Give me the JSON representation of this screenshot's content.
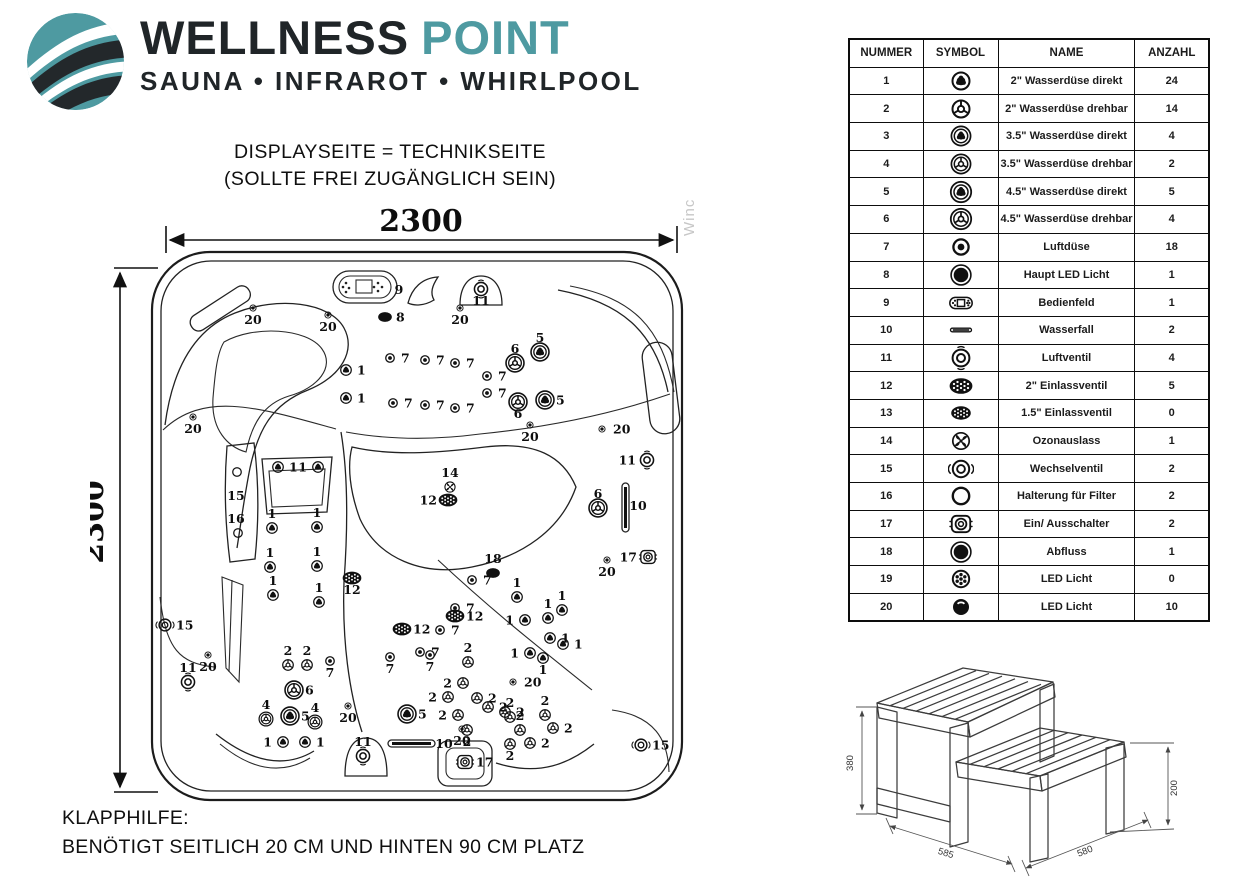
{
  "colors": {
    "teal": "#4E9AA1",
    "ink": "#202528"
  },
  "logo": {
    "icon": "globe-swoosh-icon",
    "brand_primary": "WELLNESS",
    "brand_secondary": "POINT",
    "tagline": "SAUNA • INFRAROT • WHIRLPOOL"
  },
  "note_top": {
    "line1": "DISPLAYSEITE = TECHNIKSEITE",
    "line2": "(SOLLTE FREI ZUGÄNGLICH SEIN)"
  },
  "note_bottom": {
    "line1": "KLAPPHILFE:",
    "line2": "BENÖTIGT SEITLICH 20 CM UND HINTEN 90 CM PLATZ"
  },
  "watermark": "Winc",
  "diagram": {
    "width_label": "2300",
    "height_label": "2300",
    "jets": [
      {
        "x": 253,
        "y": 308,
        "t": "dot",
        "l": "20",
        "p": "b"
      },
      {
        "x": 328,
        "y": 315,
        "t": "dot",
        "l": "20",
        "p": "b"
      },
      {
        "x": 460,
        "y": 308,
        "t": "dot",
        "l": "20",
        "p": "b"
      },
      {
        "x": 193,
        "y": 417,
        "t": "dot",
        "l": "20",
        "p": "b"
      },
      {
        "x": 385,
        "y": 317,
        "t": "dark8",
        "l": "8",
        "p": "r"
      },
      {
        "x": 399,
        "y": 290,
        "t": "none",
        "l": "9",
        "p": "c"
      },
      {
        "x": 481,
        "y": 289,
        "t": "ring11",
        "l": "11",
        "p": "b"
      },
      {
        "x": 346,
        "y": 370,
        "t": "s1",
        "l": "1",
        "p": "r"
      },
      {
        "x": 346,
        "y": 398,
        "t": "s1",
        "l": "1",
        "p": "r"
      },
      {
        "x": 390,
        "y": 358,
        "t": "a",
        "l": "7",
        "p": "r"
      },
      {
        "x": 425,
        "y": 360,
        "t": "a",
        "l": "7",
        "p": "r"
      },
      {
        "x": 455,
        "y": 363,
        "t": "a",
        "l": "7",
        "p": "r"
      },
      {
        "x": 487,
        "y": 376,
        "t": "a",
        "l": "7",
        "p": "r"
      },
      {
        "x": 393,
        "y": 403,
        "t": "a",
        "l": "7",
        "p": "r"
      },
      {
        "x": 425,
        "y": 405,
        "t": "a",
        "l": "7",
        "p": "r"
      },
      {
        "x": 455,
        "y": 408,
        "t": "a",
        "l": "7",
        "p": "r"
      },
      {
        "x": 487,
        "y": 393,
        "t": "a",
        "l": "7",
        "p": "r"
      },
      {
        "x": 515,
        "y": 363,
        "t": "b6",
        "l": "6",
        "p": "t"
      },
      {
        "x": 540,
        "y": 352,
        "t": "b5",
        "l": "5",
        "p": "t"
      },
      {
        "x": 518,
        "y": 402,
        "t": "b6",
        "l": "6",
        "p": "b"
      },
      {
        "x": 545,
        "y": 400,
        "t": "b5",
        "l": "5",
        "p": "r"
      },
      {
        "x": 530,
        "y": 425,
        "t": "dot",
        "l": "20",
        "p": "b"
      },
      {
        "x": 602,
        "y": 429,
        "t": "dot",
        "l": "20",
        "p": "r"
      },
      {
        "x": 647,
        "y": 460,
        "t": "ring11",
        "l": "11",
        "p": "l"
      },
      {
        "x": 638,
        "y": 506,
        "t": "none",
        "l": "10",
        "p": "c"
      },
      {
        "x": 648,
        "y": 557,
        "t": "sw17",
        "l": "17",
        "p": "l"
      },
      {
        "x": 607,
        "y": 560,
        "t": "dot",
        "l": "20",
        "p": "b"
      },
      {
        "x": 598,
        "y": 508,
        "t": "b6",
        "l": "6",
        "p": "t"
      },
      {
        "x": 472,
        "y": 580,
        "t": "a",
        "l": "7",
        "p": "r"
      },
      {
        "x": 455,
        "y": 608,
        "t": "a",
        "l": "7",
        "p": "r"
      },
      {
        "x": 440,
        "y": 630,
        "t": "a",
        "l": "7",
        "p": "r"
      },
      {
        "x": 420,
        "y": 652,
        "t": "a",
        "l": "7",
        "p": "r"
      },
      {
        "x": 450,
        "y": 487,
        "t": "fan",
        "l": "14",
        "p": "t"
      },
      {
        "x": 448,
        "y": 500,
        "t": "oval",
        "l": "12",
        "p": "l"
      },
      {
        "x": 352,
        "y": 578,
        "t": "oval",
        "l": "12",
        "p": "b"
      },
      {
        "x": 402,
        "y": 629,
        "t": "oval",
        "l": "12",
        "p": "r"
      },
      {
        "x": 455,
        "y": 616,
        "t": "oval",
        "l": "12",
        "p": "r"
      },
      {
        "x": 493,
        "y": 573,
        "t": "dark8",
        "l": "18",
        "p": "t"
      },
      {
        "x": 517,
        "y": 597,
        "t": "s1",
        "l": "1",
        "p": "t"
      },
      {
        "x": 525,
        "y": 620,
        "t": "s1",
        "l": "1",
        "p": "l"
      },
      {
        "x": 548,
        "y": 618,
        "t": "s1",
        "l": "1",
        "p": "t"
      },
      {
        "x": 562,
        "y": 610,
        "t": "s1",
        "l": "1",
        "p": "t"
      },
      {
        "x": 550,
        "y": 638,
        "t": "s1",
        "l": "1",
        "p": "r"
      },
      {
        "x": 563,
        "y": 644,
        "t": "s1",
        "l": "1",
        "p": "r"
      },
      {
        "x": 530,
        "y": 653,
        "t": "s1",
        "l": "1",
        "p": "l"
      },
      {
        "x": 543,
        "y": 658,
        "t": "s1",
        "l": "1",
        "p": "b"
      },
      {
        "x": 272,
        "y": 528,
        "t": "s1",
        "l": "1",
        "p": "t"
      },
      {
        "x": 317,
        "y": 527,
        "t": "s1",
        "l": "1",
        "p": "t"
      },
      {
        "x": 270,
        "y": 567,
        "t": "s1",
        "l": "1",
        "p": "t"
      },
      {
        "x": 317,
        "y": 566,
        "t": "s1",
        "l": "1",
        "p": "t"
      },
      {
        "x": 273,
        "y": 595,
        "t": "s1",
        "l": "1",
        "p": "t"
      },
      {
        "x": 319,
        "y": 602,
        "t": "s1",
        "l": "1",
        "p": "t"
      },
      {
        "x": 278,
        "y": 467,
        "t": "s1",
        "l": "1",
        "p": "r"
      },
      {
        "x": 318,
        "y": 467,
        "t": "s1",
        "l": "1",
        "p": "l"
      },
      {
        "x": 237,
        "y": 472,
        "t": "c16",
        "l": "",
        "p": "c"
      },
      {
        "x": 238,
        "y": 533,
        "t": "c16",
        "l": "",
        "p": "c"
      },
      {
        "x": 236,
        "y": 496,
        "t": "none",
        "l": "15",
        "p": "c"
      },
      {
        "x": 236,
        "y": 519,
        "t": "none",
        "l": "16",
        "p": "c"
      },
      {
        "x": 208,
        "y": 655,
        "t": "dot",
        "l": "20",
        "p": "b"
      },
      {
        "x": 188,
        "y": 682,
        "t": "ring11",
        "l": "11",
        "p": "t"
      },
      {
        "x": 165,
        "y": 625,
        "t": "div15",
        "l": "15",
        "p": "r"
      },
      {
        "x": 288,
        "y": 665,
        "t": "s2",
        "l": "2",
        "p": "t"
      },
      {
        "x": 307,
        "y": 665,
        "t": "s2",
        "l": "2",
        "p": "t"
      },
      {
        "x": 330,
        "y": 661,
        "t": "a",
        "l": "7",
        "p": "b"
      },
      {
        "x": 294,
        "y": 690,
        "t": "b6",
        "l": "6",
        "p": "r"
      },
      {
        "x": 290,
        "y": 716,
        "t": "b5",
        "l": "5",
        "p": "r"
      },
      {
        "x": 266,
        "y": 719,
        "t": "b4",
        "l": "4",
        "p": "t"
      },
      {
        "x": 315,
        "y": 722,
        "t": "b4",
        "l": "4",
        "p": "t"
      },
      {
        "x": 283,
        "y": 742,
        "t": "s1",
        "l": "1",
        "p": "l"
      },
      {
        "x": 305,
        "y": 742,
        "t": "s1",
        "l": "1",
        "p": "r"
      },
      {
        "x": 348,
        "y": 706,
        "t": "dot",
        "l": "20",
        "p": "b"
      },
      {
        "x": 407,
        "y": 714,
        "t": "b5",
        "l": "5",
        "p": "r"
      },
      {
        "x": 390,
        "y": 657,
        "t": "a",
        "l": "7",
        "p": "b"
      },
      {
        "x": 430,
        "y": 655,
        "t": "a",
        "l": "7",
        "p": "b"
      },
      {
        "x": 444,
        "y": 744,
        "t": "none",
        "l": "10",
        "p": "c"
      },
      {
        "x": 363,
        "y": 756,
        "t": "ring11",
        "l": "11",
        "p": "t"
      },
      {
        "x": 462,
        "y": 729,
        "t": "dot",
        "l": "20",
        "p": "b"
      },
      {
        "x": 465,
        "y": 762,
        "t": "sw17",
        "l": "17",
        "p": "r"
      },
      {
        "x": 468,
        "y": 662,
        "t": "s2",
        "l": "2",
        "p": "t"
      },
      {
        "x": 463,
        "y": 683,
        "t": "s2",
        "l": "2",
        "p": "l"
      },
      {
        "x": 448,
        "y": 697,
        "t": "s2",
        "l": "2",
        "p": "l"
      },
      {
        "x": 477,
        "y": 698,
        "t": "s2",
        "l": "2",
        "p": "r"
      },
      {
        "x": 458,
        "y": 715,
        "t": "s2",
        "l": "2",
        "p": "l"
      },
      {
        "x": 488,
        "y": 707,
        "t": "s2",
        "l": "2",
        "p": "r"
      },
      {
        "x": 505,
        "y": 712,
        "t": "s2",
        "l": "2",
        "p": "r"
      },
      {
        "x": 467,
        "y": 730,
        "t": "s2",
        "l": "2",
        "p": "b"
      },
      {
        "x": 510,
        "y": 717,
        "t": "s2",
        "l": "2",
        "p": "t"
      },
      {
        "x": 520,
        "y": 730,
        "t": "s2",
        "l": "2",
        "p": "t"
      },
      {
        "x": 510,
        "y": 744,
        "t": "s2",
        "l": "2",
        "p": "b"
      },
      {
        "x": 530,
        "y": 743,
        "t": "s2",
        "l": "2",
        "p": "r"
      },
      {
        "x": 545,
        "y": 715,
        "t": "s2",
        "l": "2",
        "p": "t"
      },
      {
        "x": 553,
        "y": 728,
        "t": "s2",
        "l": "2",
        "p": "r"
      },
      {
        "x": 513,
        "y": 682,
        "t": "dot",
        "l": "20",
        "p": "r"
      },
      {
        "x": 641,
        "y": 745,
        "t": "div15",
        "l": "15",
        "p": "r"
      }
    ]
  },
  "table": {
    "headers": [
      "NUMMER",
      "SYMBOL",
      "NAME",
      "ANZAHL"
    ],
    "rows": [
      {
        "num": "1",
        "t": "s1",
        "symbol": "jet-2in-direct-icon",
        "name": "2\" Wasserdüse direkt",
        "qty": "24"
      },
      {
        "num": "2",
        "t": "s2",
        "symbol": "jet-2in-rotate-icon",
        "name": "2\" Wasserdüse drehbar",
        "qty": "14"
      },
      {
        "num": "3",
        "t": "m3",
        "symbol": "jet-3.5in-direct-icon",
        "name": "3.5\" Wasserdüse direkt",
        "qty": "4"
      },
      {
        "num": "4",
        "t": "b4",
        "symbol": "jet-3.5in-rotate-icon",
        "name": "3.5\" Wasserdüse drehbar",
        "qty": "2"
      },
      {
        "num": "5",
        "t": "b5",
        "symbol": "jet-4.5in-direct-icon",
        "name": "4.5\" Wasserdüse direkt",
        "qty": "5"
      },
      {
        "num": "6",
        "t": "b6",
        "symbol": "jet-4.5in-rotate-icon",
        "name": "4.5\" Wasserdüse drehbar",
        "qty": "4"
      },
      {
        "num": "7",
        "t": "a",
        "symbol": "air-jet-icon",
        "name": "Luftdüse",
        "qty": "18"
      },
      {
        "num": "8",
        "t": "drain",
        "symbol": "main-led-icon",
        "name": "Haupt LED Licht",
        "qty": "1"
      },
      {
        "num": "9",
        "t": "panel",
        "symbol": "control-panel-icon",
        "name": "Bedienfeld",
        "qty": "1"
      },
      {
        "num": "10",
        "t": "bar",
        "symbol": "waterfall-icon",
        "name": "Wasserfall",
        "qty": "2"
      },
      {
        "num": "11",
        "t": "ring11",
        "symbol": "air-valve-icon",
        "name": "Luftventil",
        "qty": "4"
      },
      {
        "num": "12",
        "t": "oval",
        "symbol": "inlet-valve-2in-icon",
        "name": "2\" Einlassventil",
        "qty": "5"
      },
      {
        "num": "13",
        "t": "oval13",
        "symbol": "inlet-valve-1.5in-icon",
        "name": "1.5\" Einlassventil",
        "qty": "0"
      },
      {
        "num": "14",
        "t": "fan",
        "symbol": "ozone-outlet-icon",
        "name": "Ozonauslass",
        "qty": "1"
      },
      {
        "num": "15",
        "t": "div15",
        "symbol": "diverter-valve-icon",
        "name": "Wechselventil",
        "qty": "2"
      },
      {
        "num": "16",
        "t": "c16",
        "symbol": "filter-mount-icon",
        "name": "Halterung für Filter",
        "qty": "2"
      },
      {
        "num": "17",
        "t": "sw17",
        "symbol": "power-switch-icon",
        "name": "Ein/ Ausschalter",
        "qty": "2"
      },
      {
        "num": "18",
        "t": "drain",
        "symbol": "drain-icon",
        "name": "Abfluss",
        "qty": "1"
      },
      {
        "num": "19",
        "t": "led19",
        "symbol": "led-light-icon",
        "name": "LED Licht",
        "qty": "0"
      },
      {
        "num": "20",
        "t": "led20",
        "symbol": "led-light-dark-icon",
        "name": "LED Licht",
        "qty": "10"
      }
    ]
  },
  "steps": {
    "total_height": "380",
    "step_height": "200",
    "depth_left": "585",
    "depth_right": "580"
  }
}
